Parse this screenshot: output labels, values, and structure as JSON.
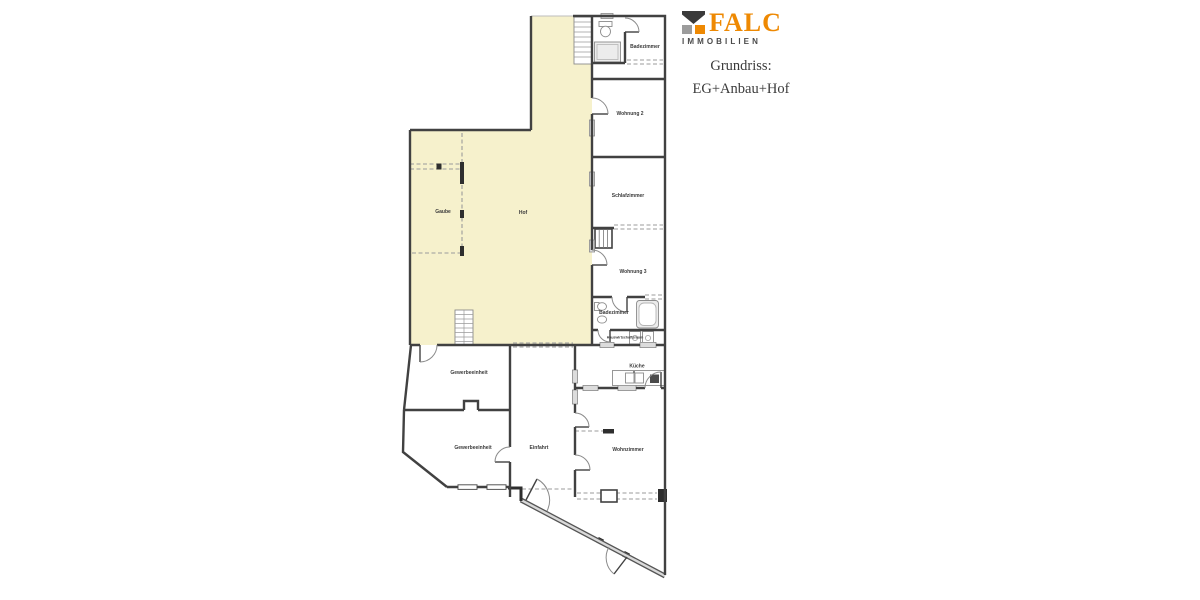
{
  "header": {
    "brand": "FALC",
    "brand_sub": "IMMOBILIEN",
    "subtitle_line1": "Grundriss:",
    "subtitle_line2": "EG+Anbau+Hof",
    "colors": {
      "brand_orange": "#EE8903",
      "logo_dark": "#3A3A3A",
      "logo_gray": "#9C9C9C",
      "text": "#3B3B3B"
    }
  },
  "floorplan": {
    "colors": {
      "wall": "#414141",
      "hof_fill": "#F6F1CC",
      "dash": "#9B9B9B",
      "fixture_fill": "#ECECEC"
    },
    "labels": {
      "hof": "Hof",
      "gaube": "Gaube",
      "badezimmer_top": "Badezimmer",
      "wohnung_2": "Wohnung 2",
      "schlafzimmer": "Schlafzimmer",
      "wohnung_3": "Wohnung 3",
      "badezimmer_2": "Badezimmer",
      "hauswirtschaftsraum": "Hauswirtschaftsraum",
      "kueche": "Küche",
      "wohnzimmer": "Wohnzimmer",
      "gewerbeeinheit_1": "Gewerbeeinheit",
      "gewerbeeinheit_2": "Gewerbeeinheit",
      "einfahrt": "Einfahrt"
    }
  }
}
